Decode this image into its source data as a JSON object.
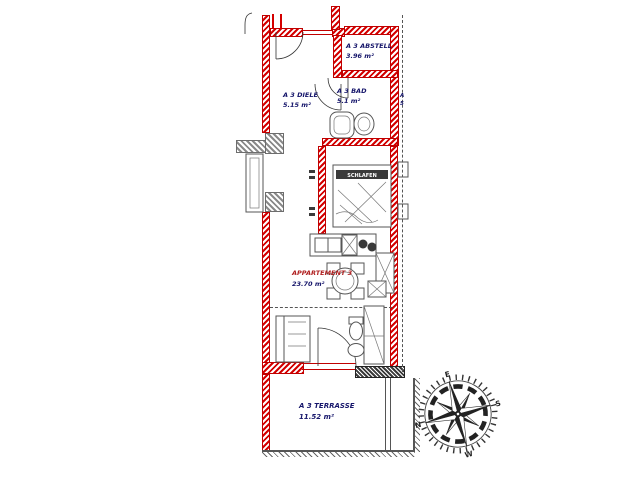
{
  "drawing_title": "Apartment floor plan A 3",
  "labels": {
    "abstell": {
      "name": "A 3 ABSTELL",
      "area": "3.96 m²"
    },
    "diele": {
      "name": "A 3 DIELE",
      "area": "5.15 m²"
    },
    "bad": {
      "name": "A 3 BAD",
      "area": "5.1 m²"
    },
    "schlafen": {
      "name": "SCHLAFEN"
    },
    "apartment": {
      "name": "APPARTEMENT 3",
      "area": "23.70 m²"
    },
    "terrasse": {
      "name": "A 3 TERRASSE",
      "area": "11.52 m²"
    },
    "neighbor_unit": {
      "line1": "A",
      "line2": "5"
    }
  },
  "compass": {
    "north": "N",
    "east": "E",
    "south": "S",
    "west": "W"
  },
  "colors": {
    "wall_red": "#d40000",
    "wall_gray": "#8a8a8a",
    "hatch_dark": "#3a3a3a",
    "label_navy": "#16166b",
    "label_red": "#b02020",
    "background": "#ffffff"
  }
}
